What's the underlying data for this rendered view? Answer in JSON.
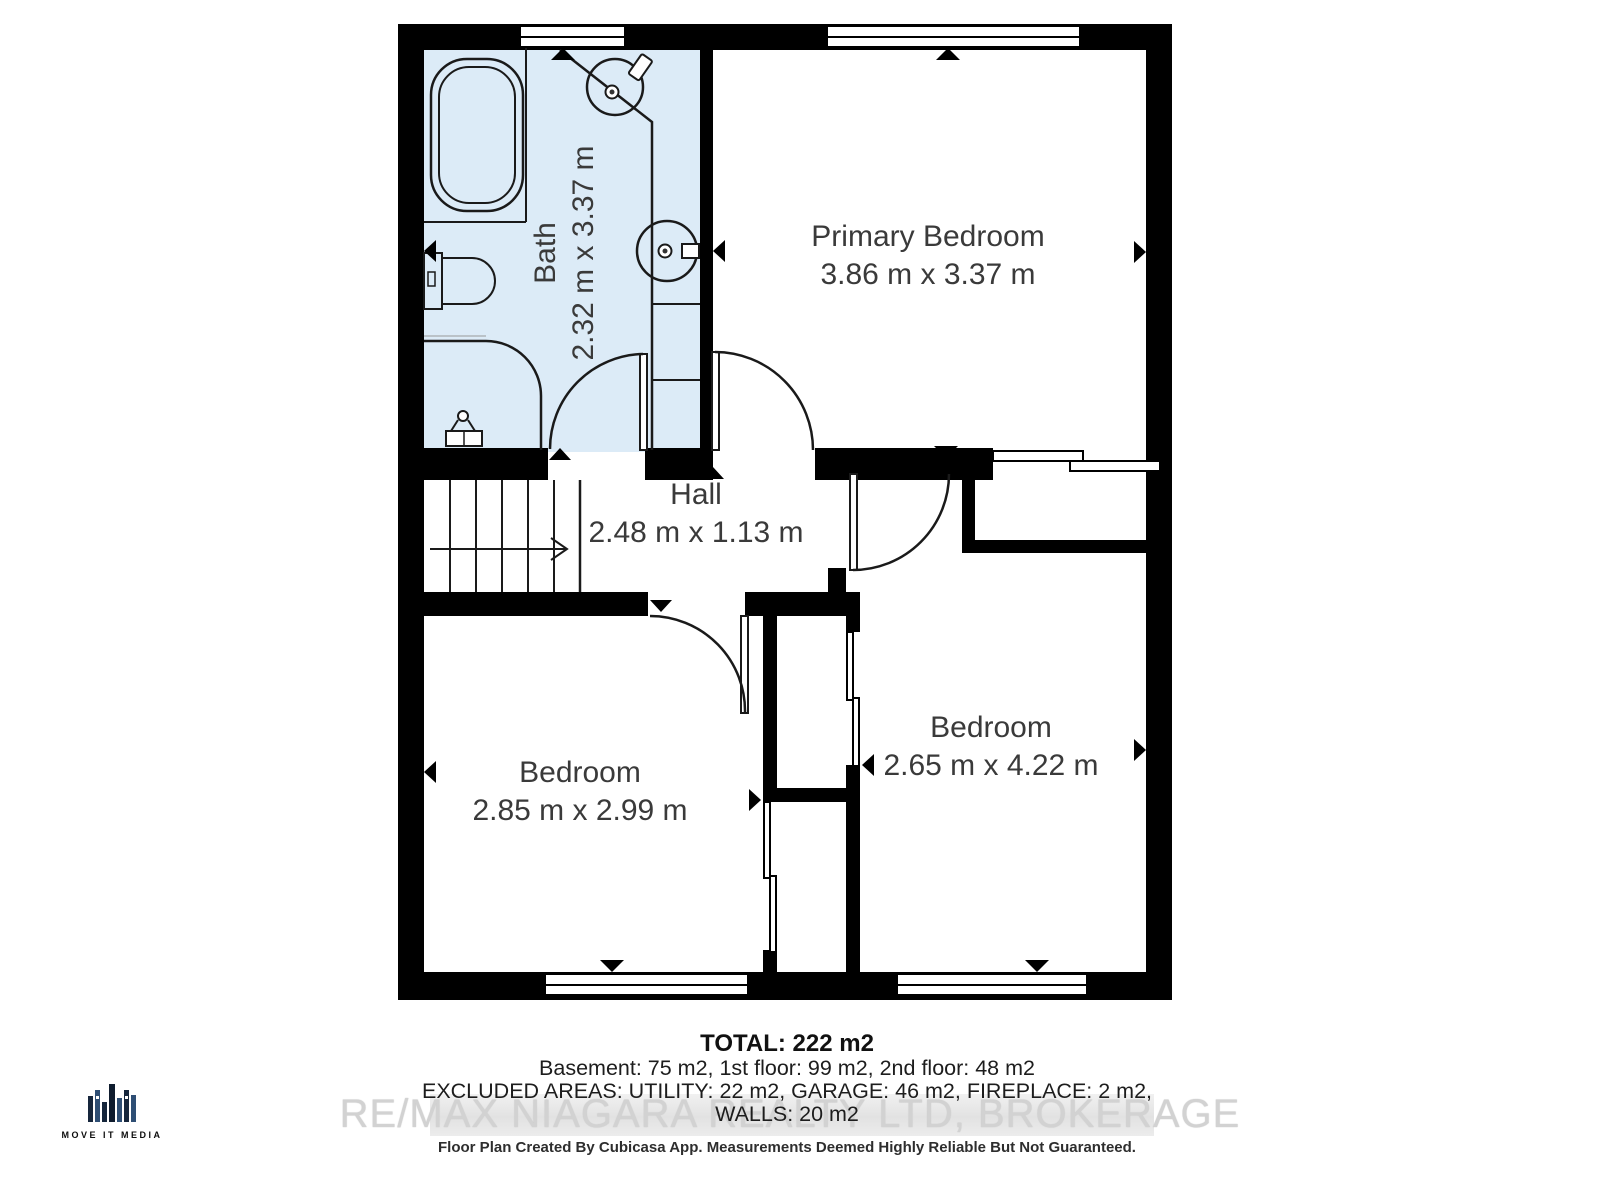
{
  "rooms": {
    "bath": {
      "name": "Bath",
      "dims": "2.32 m x 3.37 m"
    },
    "primary_bedroom": {
      "name": "Primary Bedroom",
      "dims": "3.86 m x 3.37 m"
    },
    "hall": {
      "name": "Hall",
      "dims": "2.48 m x 1.13 m"
    },
    "bedroom_left": {
      "name": "Bedroom",
      "dims": "2.85 m x 2.99 m"
    },
    "bedroom_right": {
      "name": "Bedroom",
      "dims": "2.65 m x 4.22 m"
    }
  },
  "summary": {
    "total": "TOTAL: 222 m2",
    "floors": "Basement: 75 m2, 1st floor: 99 m2, 2nd floor: 48 m2",
    "excluded": "EXCLUDED AREAS: UTILITY: 22 m2, GARAGE: 46 m2, FIREPLACE: 2 m2,",
    "walls": "WALLS: 20 m2"
  },
  "watermark": "RE/MAX NIAGARA REALTY LTD, BROKERAGE",
  "disclaimer": "Floor Plan Created By Cubicasa App. Measurements Deemed Highly Reliable But Not Guaranteed.",
  "logo": {
    "text": "MOVE IT MEDIA"
  },
  "icons": {
    "fixtures": [
      "bathtub-icon",
      "toilet-icon",
      "sink-icon",
      "shower-door-icon",
      "stairs-icon",
      "door-arc-icon",
      "window-icon",
      "sliding-door-icon",
      "direction-marker-icon"
    ]
  },
  "colors": {
    "wall": "#000000",
    "bath_fill": "#dcebf7",
    "line": "#1a1a1a",
    "label_text": "#3a3a3a",
    "watermark_text": "#d2d2d2",
    "logo_navy": "#16263c",
    "logo_blue": "#2e4e74"
  }
}
